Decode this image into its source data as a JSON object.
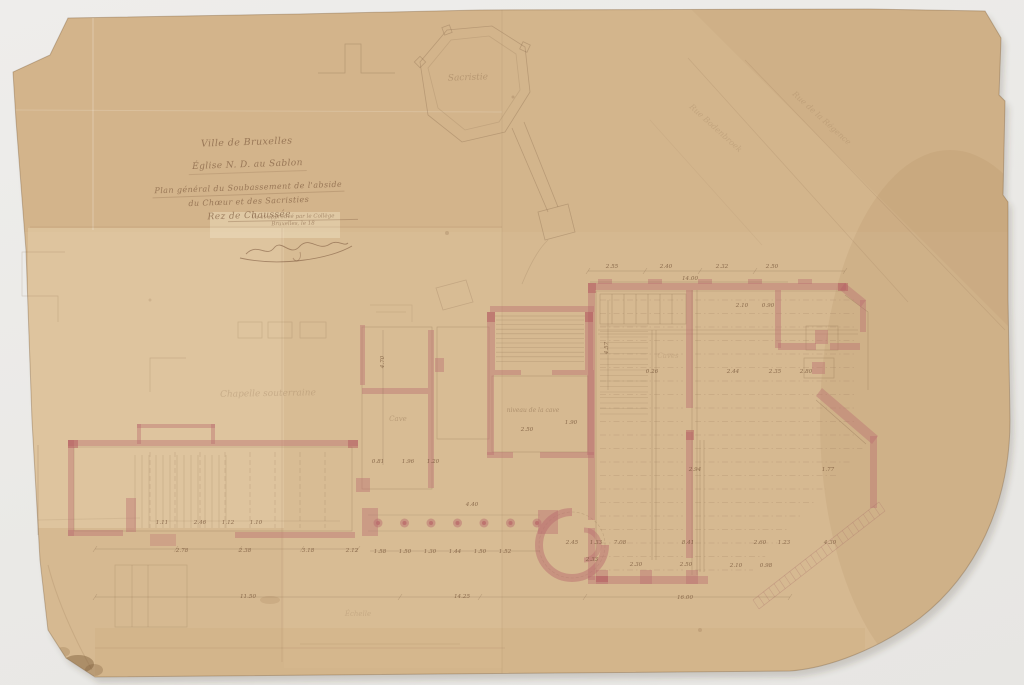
{
  "title_block": {
    "lines": [
      "Ville de Bruxelles",
      "Église N. D. au Sablon",
      "Plan général du Soubassement de l'abside",
      "du Chœur et des Sacristies",
      "Rez de Chaussée"
    ],
    "approval_lines": [
      "Vu et approuvé par le Collège",
      "Bruxelles, le 18"
    ]
  },
  "plan": {
    "script_labels": [
      {
        "t": "Sacristie",
        "x": 468,
        "y": 80,
        "s": 9,
        "o": 0.28,
        "r": -2
      },
      {
        "t": "Chapelle souterraine",
        "x": 268,
        "y": 396,
        "s": 9,
        "o": 0.2,
        "r": -1
      },
      {
        "t": "Cave",
        "x": 398,
        "y": 421,
        "s": 7,
        "o": 0.28,
        "r": 0
      },
      {
        "t": "Caves",
        "x": 668,
        "y": 358,
        "s": 7,
        "o": 0.16,
        "r": 0
      },
      {
        "t": "niveau de la cave",
        "x": 533,
        "y": 412,
        "s": 6,
        "o": 0.38,
        "r": 0
      },
      {
        "t": "Échelle",
        "x": 358,
        "y": 616,
        "s": 7,
        "o": 0.16,
        "r": 0
      },
      {
        "t": "Rue Bodenbroek",
        "x": 714,
        "y": 130,
        "s": 8,
        "o": 0.15,
        "r": 42
      },
      {
        "t": "Rue de la Régence",
        "x": 820,
        "y": 120,
        "s": 8,
        "o": 0.15,
        "r": 42
      }
    ],
    "dimension_labels": [
      {
        "t": "2.55",
        "x": 612,
        "y": 268
      },
      {
        "t": "2.40",
        "x": 666,
        "y": 268
      },
      {
        "t": "2.32",
        "x": 722,
        "y": 268
      },
      {
        "t": "2.50",
        "x": 772,
        "y": 268
      },
      {
        "t": "14.00",
        "x": 690,
        "y": 280
      },
      {
        "t": "2.10",
        "x": 742,
        "y": 307
      },
      {
        "t": "0.90",
        "x": 768,
        "y": 307
      },
      {
        "t": "0.26",
        "x": 652,
        "y": 373
      },
      {
        "t": "2.44",
        "x": 733,
        "y": 373
      },
      {
        "t": "2.35",
        "x": 775,
        "y": 373
      },
      {
        "t": "2.80",
        "x": 806,
        "y": 373
      },
      {
        "t": "2.94",
        "x": 695,
        "y": 471
      },
      {
        "t": "1.77",
        "x": 828,
        "y": 471
      },
      {
        "t": "2.45",
        "x": 572,
        "y": 544
      },
      {
        "t": "1.33",
        "x": 596,
        "y": 544
      },
      {
        "t": "7.08",
        "x": 620,
        "y": 544
      },
      {
        "t": "8.41",
        "x": 688,
        "y": 544
      },
      {
        "t": "2.60",
        "x": 760,
        "y": 544
      },
      {
        "t": "1.23",
        "x": 784,
        "y": 544
      },
      {
        "t": "4.30",
        "x": 830,
        "y": 544
      },
      {
        "t": "2.33",
        "x": 592,
        "y": 561
      },
      {
        "t": "2.30",
        "x": 636,
        "y": 566
      },
      {
        "t": "2.50",
        "x": 686,
        "y": 566
      },
      {
        "t": "2.10",
        "x": 736,
        "y": 567
      },
      {
        "t": "0.98",
        "x": 766,
        "y": 567
      },
      {
        "t": "16.00",
        "x": 685,
        "y": 599
      },
      {
        "t": "1.11",
        "x": 162,
        "y": 524
      },
      {
        "t": "2.46",
        "x": 200,
        "y": 524
      },
      {
        "t": "1.12",
        "x": 228,
        "y": 524
      },
      {
        "t": "1.10",
        "x": 256,
        "y": 524
      },
      {
        "t": "2.78",
        "x": 182,
        "y": 552
      },
      {
        "t": "2.38",
        "x": 245,
        "y": 552
      },
      {
        "t": "3.18",
        "x": 308,
        "y": 552
      },
      {
        "t": "2.12",
        "x": 352,
        "y": 552
      },
      {
        "t": "0.81",
        "x": 378,
        "y": 463
      },
      {
        "t": "1.96",
        "x": 408,
        "y": 463
      },
      {
        "t": "1.20",
        "x": 433,
        "y": 463
      },
      {
        "t": "1.58",
        "x": 380,
        "y": 553
      },
      {
        "t": "1.50",
        "x": 405,
        "y": 553
      },
      {
        "t": "1.30",
        "x": 430,
        "y": 553
      },
      {
        "t": "1.44",
        "x": 455,
        "y": 553
      },
      {
        "t": "1.50",
        "x": 480,
        "y": 553
      },
      {
        "t": "1.52",
        "x": 505,
        "y": 553
      },
      {
        "t": "4.40",
        "x": 472,
        "y": 506
      },
      {
        "t": "11.50",
        "x": 248,
        "y": 598
      },
      {
        "t": "14.25",
        "x": 462,
        "y": 598
      },
      {
        "t": "2.50",
        "x": 527,
        "y": 431
      },
      {
        "t": "1.90",
        "x": 571,
        "y": 424
      },
      {
        "t": "4.70",
        "x": 384,
        "y": 362,
        "r": -90
      },
      {
        "t": "4.57",
        "x": 608,
        "y": 348,
        "r": -90
      }
    ],
    "colors": {
      "background": "#ecebe9",
      "paper": "#d6b991",
      "paper_light": "#e3cba6",
      "paper_dark": "#cfae83",
      "wall_wash": "#c47a7c",
      "pencil": "#7b5c42",
      "ink": "#7a5638"
    }
  }
}
